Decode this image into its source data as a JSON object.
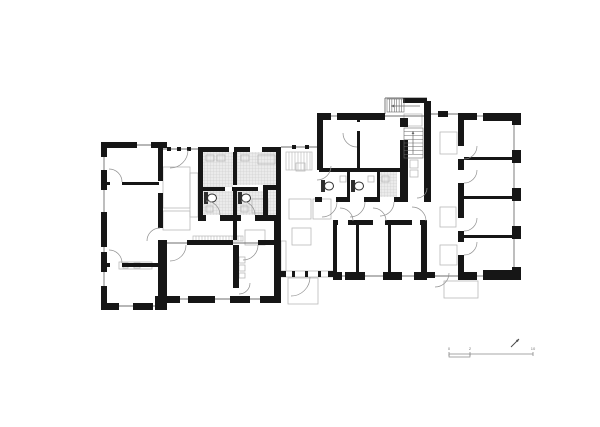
{
  "canvas": {
    "width": 600,
    "height": 427,
    "background": "#ffffff"
  },
  "colors": {
    "wall": "#161616",
    "window_line": "#6f6f6f",
    "hatch_bg": "#ebebeb",
    "hatch_line": "#c9c9c9",
    "light": "#b9b9b9",
    "fixture": "#2e2e2e",
    "arc": "#8f8f8f",
    "stair": "#6a6a6a",
    "light_stair": "#b5b5b5",
    "scale": "#8a8a8a",
    "scale_text": "#777777",
    "north": "#4a4a4a"
  },
  "plan": {
    "walls": [
      [
        101,
        142,
        6,
        15
      ],
      [
        101,
        170,
        6,
        20
      ],
      [
        101,
        212,
        6,
        35
      ],
      [
        101,
        252,
        6,
        20
      ],
      [
        101,
        286,
        6,
        24
      ],
      [
        101,
        303,
        18,
        7
      ],
      [
        133,
        303,
        20,
        7
      ],
      [
        155,
        296,
        12,
        14
      ],
      [
        101,
        142,
        36,
        6
      ],
      [
        151,
        142,
        16,
        6
      ],
      [
        158,
        148,
        5,
        33
      ],
      [
        158,
        193,
        5,
        35
      ],
      [
        158,
        240,
        9,
        58
      ],
      [
        107,
        182,
        3,
        3
      ],
      [
        122,
        182,
        37,
        3
      ],
      [
        107,
        263,
        3,
        4
      ],
      [
        122,
        263,
        37,
        4
      ],
      [
        198,
        147,
        5,
        74
      ],
      [
        198,
        147,
        31,
        5
      ],
      [
        234,
        147,
        16,
        5
      ],
      [
        262,
        147,
        19,
        5
      ],
      [
        276,
        147,
        5,
        74
      ],
      [
        263,
        185,
        15,
        5
      ],
      [
        263,
        190,
        5,
        26
      ],
      [
        233,
        152,
        4,
        33
      ],
      [
        233,
        191,
        4,
        25
      ],
      [
        203,
        187,
        22,
        4
      ],
      [
        232,
        187,
        26,
        4
      ],
      [
        198,
        215,
        8,
        6
      ],
      [
        220,
        215,
        21,
        6
      ],
      [
        255,
        215,
        21,
        6
      ],
      [
        233,
        221,
        4,
        19
      ],
      [
        317,
        113,
        14,
        7
      ],
      [
        337,
        113,
        48,
        7
      ],
      [
        317,
        113,
        6,
        57
      ],
      [
        357,
        118,
        3,
        4
      ],
      [
        357,
        131,
        3,
        37
      ],
      [
        400,
        118,
        8,
        9
      ],
      [
        400,
        140,
        8,
        62
      ],
      [
        424,
        101,
        7,
        96
      ],
      [
        403,
        98,
        24,
        5
      ],
      [
        319,
        168,
        81,
        4
      ],
      [
        315,
        197,
        7,
        5
      ],
      [
        336,
        197,
        14,
        5
      ],
      [
        364,
        197,
        16,
        5
      ],
      [
        394,
        197,
        14,
        5
      ],
      [
        424,
        197,
        7,
        5
      ],
      [
        347,
        172,
        3,
        25
      ],
      [
        377,
        172,
        3,
        25
      ],
      [
        458,
        113,
        19,
        7
      ],
      [
        483,
        113,
        38,
        8
      ],
      [
        458,
        113,
        6,
        33
      ],
      [
        458,
        159,
        6,
        11
      ],
      [
        458,
        183,
        6,
        35
      ],
      [
        458,
        231,
        6,
        11
      ],
      [
        458,
        255,
        6,
        17
      ],
      [
        512,
        113,
        9,
        12
      ],
      [
        512,
        150,
        9,
        13
      ],
      [
        512,
        188,
        9,
        13
      ],
      [
        512,
        226,
        9,
        13
      ],
      [
        512,
        267,
        9,
        13
      ],
      [
        464,
        157,
        48,
        3
      ],
      [
        464,
        196,
        48,
        3
      ],
      [
        464,
        235,
        48,
        3
      ],
      [
        458,
        272,
        19,
        8
      ],
      [
        483,
        270,
        38,
        10
      ],
      [
        438,
        111,
        10,
        6
      ],
      [
        333,
        220,
        5,
        5
      ],
      [
        348,
        220,
        25,
        5
      ],
      [
        385,
        220,
        27,
        5
      ],
      [
        420,
        220,
        7,
        5
      ],
      [
        333,
        220,
        4,
        60
      ],
      [
        421,
        220,
        6,
        60
      ],
      [
        356,
        225,
        3,
        47
      ],
      [
        388,
        225,
        3,
        47
      ],
      [
        333,
        272,
        9,
        8
      ],
      [
        345,
        272,
        20,
        8
      ],
      [
        383,
        272,
        19,
        8
      ],
      [
        414,
        272,
        13,
        8
      ],
      [
        427,
        272,
        8,
        6
      ],
      [
        187,
        240,
        46,
        5
      ],
      [
        258,
        240,
        22,
        5
      ],
      [
        233,
        245,
        6,
        43
      ],
      [
        274,
        220,
        7,
        78
      ],
      [
        158,
        296,
        22,
        7
      ],
      [
        188,
        296,
        27,
        7
      ],
      [
        230,
        296,
        20,
        7
      ],
      [
        260,
        296,
        21,
        7
      ],
      [
        280,
        271,
        6,
        6
      ],
      [
        292,
        271,
        3,
        6
      ],
      [
        305,
        271,
        3,
        6
      ],
      [
        318,
        271,
        3,
        6
      ],
      [
        328,
        271,
        5,
        6
      ],
      [
        167,
        147,
        4,
        4
      ],
      [
        177,
        147,
        4,
        4
      ],
      [
        187,
        147,
        4,
        4
      ],
      [
        292,
        145,
        4,
        4
      ],
      [
        305,
        145,
        4,
        4
      ]
    ],
    "windows": [
      [
        104,
        145,
        162,
        145
      ],
      [
        104,
        148,
        104,
        302
      ],
      [
        104,
        306,
        160,
        306
      ],
      [
        162,
        149,
        198,
        149
      ],
      [
        281,
        147,
        317,
        147
      ],
      [
        162,
        299,
        280,
        299
      ],
      [
        162,
        243,
        280,
        243
      ],
      [
        331,
        116,
        337,
        116
      ],
      [
        385,
        116,
        424,
        116
      ],
      [
        431,
        114,
        458,
        114
      ],
      [
        385,
        98,
        427,
        98
      ],
      [
        385,
        98,
        385,
        114
      ],
      [
        477,
        116,
        483,
        116
      ],
      [
        514,
        113,
        514,
        280
      ],
      [
        477,
        276,
        483,
        276
      ],
      [
        333,
        276,
        427,
        276
      ],
      [
        427,
        276,
        458,
        276
      ]
    ],
    "hatches": [
      [
        203,
        152,
        30,
        35
      ],
      [
        237,
        152,
        39,
        33
      ],
      [
        203,
        191,
        30,
        24
      ],
      [
        237,
        191,
        26,
        24
      ],
      [
        268,
        190,
        8,
        25
      ],
      [
        380,
        172,
        17,
        25
      ]
    ],
    "lights": [
      [
        163,
        167,
        27,
        41
      ],
      [
        163,
        211,
        27,
        19
      ],
      [
        190,
        173,
        8,
        44
      ],
      [
        252,
        199,
        16,
        14
      ],
      [
        245,
        230,
        20,
        15
      ],
      [
        289,
        199,
        22,
        20
      ],
      [
        313,
        199,
        18,
        20
      ],
      [
        292,
        228,
        19,
        17
      ],
      [
        288,
        278,
        30,
        26
      ],
      [
        440,
        132,
        17,
        22
      ],
      [
        440,
        207,
        16,
        20
      ],
      [
        440,
        245,
        17,
        20
      ],
      [
        444,
        281,
        34,
        17
      ],
      [
        119,
        262,
        33,
        7
      ],
      [
        123,
        263,
        5,
        5
      ],
      [
        134,
        263,
        6,
        5
      ],
      [
        281,
        241,
        5,
        30
      ],
      [
        280,
        271,
        53,
        6
      ],
      [
        404,
        114,
        18,
        12
      ],
      [
        296,
        163,
        9,
        8
      ],
      [
        239,
        257,
        6,
        6
      ],
      [
        239,
        265,
        6,
        6
      ],
      [
        239,
        273,
        6,
        5
      ],
      [
        410,
        160,
        8,
        8
      ],
      [
        410,
        170,
        8,
        7
      ],
      [
        206,
        155,
        8,
        6
      ],
      [
        217,
        155,
        8,
        6
      ],
      [
        241,
        155,
        8,
        6
      ],
      [
        258,
        155,
        17,
        9
      ],
      [
        206,
        206,
        7,
        6
      ],
      [
        241,
        206,
        7,
        6
      ],
      [
        340,
        176,
        6,
        6
      ],
      [
        368,
        176,
        6,
        6
      ],
      [
        382,
        176,
        7,
        6
      ]
    ],
    "toilets": [
      {
        "cistern": [
          204,
          192,
          4,
          12
        ],
        "bowl": [
          212,
          198,
          4.5,
          4
        ]
      },
      {
        "cistern": [
          238,
          192,
          4,
          12
        ],
        "bowl": [
          246,
          198,
          4.5,
          4
        ]
      },
      {
        "cistern": [
          321,
          180,
          4,
          12
        ],
        "bowl": [
          329,
          186,
          4.5,
          4
        ]
      },
      {
        "cistern": [
          351,
          180,
          4,
          12
        ],
        "bowl": [
          359,
          186,
          4.5,
          4
        ]
      }
    ],
    "arcs": [
      [
        170,
        150,
        18,
        0,
        90
      ],
      [
        109,
        182,
        13,
        270,
        360
      ],
      [
        109,
        263,
        13,
        270,
        360
      ],
      [
        160,
        241,
        13,
        180,
        270
      ],
      [
        170,
        245,
        16,
        0,
        90
      ],
      [
        243,
        245,
        15,
        0,
        90
      ],
      [
        239,
        283,
        11,
        0,
        90
      ],
      [
        206,
        215,
        14,
        270,
        360
      ],
      [
        241,
        215,
        14,
        270,
        360
      ],
      [
        291,
        277,
        19,
        0,
        90
      ],
      [
        435,
        273,
        14,
        0,
        90
      ],
      [
        340,
        221,
        13,
        270,
        360
      ],
      [
        373,
        221,
        13,
        270,
        360
      ],
      [
        412,
        221,
        14,
        270,
        360
      ],
      [
        464,
        146,
        13,
        0,
        90
      ],
      [
        464,
        170,
        13,
        0,
        90
      ],
      [
        464,
        218,
        13,
        0,
        90
      ],
      [
        464,
        242,
        13,
        0,
        90
      ],
      [
        317,
        166,
        14,
        0,
        90
      ],
      [
        357,
        133,
        14,
        90,
        180
      ],
      [
        322,
        202,
        15,
        0,
        90
      ],
      [
        350,
        202,
        15,
        0,
        90
      ],
      [
        380,
        202,
        14,
        0,
        90
      ],
      [
        417,
        188,
        10,
        0,
        90
      ]
    ],
    "stairs": [
      {
        "x": 404,
        "y": 128,
        "w": 19,
        "h": 30,
        "n": 8,
        "dir": "h"
      },
      {
        "x": 387,
        "y": 99,
        "w": 17,
        "h": 13,
        "n": 7,
        "dir": "v"
      }
    ],
    "light_stripes": [
      {
        "x": 286,
        "y": 152,
        "w": 26,
        "h": 18,
        "step": 3
      },
      {
        "x": 193,
        "y": 236,
        "w": 50,
        "h": 5,
        "step": 3
      }
    ],
    "arrows": [
      [
        413,
        154,
        413,
        131
      ],
      [
        420,
        106,
        391,
        106
      ]
    ]
  },
  "scalebar": {
    "y": 354,
    "x1": 449,
    "x2": 533,
    "ticks": [
      449,
      470,
      533
    ],
    "bracket": [
      449,
      470
    ],
    "labels": [
      {
        "t": "0",
        "x": 449
      },
      {
        "t": "2",
        "x": 470
      },
      {
        "t": "10",
        "x": 533
      }
    ],
    "label_y": 350
  },
  "north_arrow": {
    "x1": 511,
    "y1": 347,
    "x2": 519,
    "y2": 339
  }
}
